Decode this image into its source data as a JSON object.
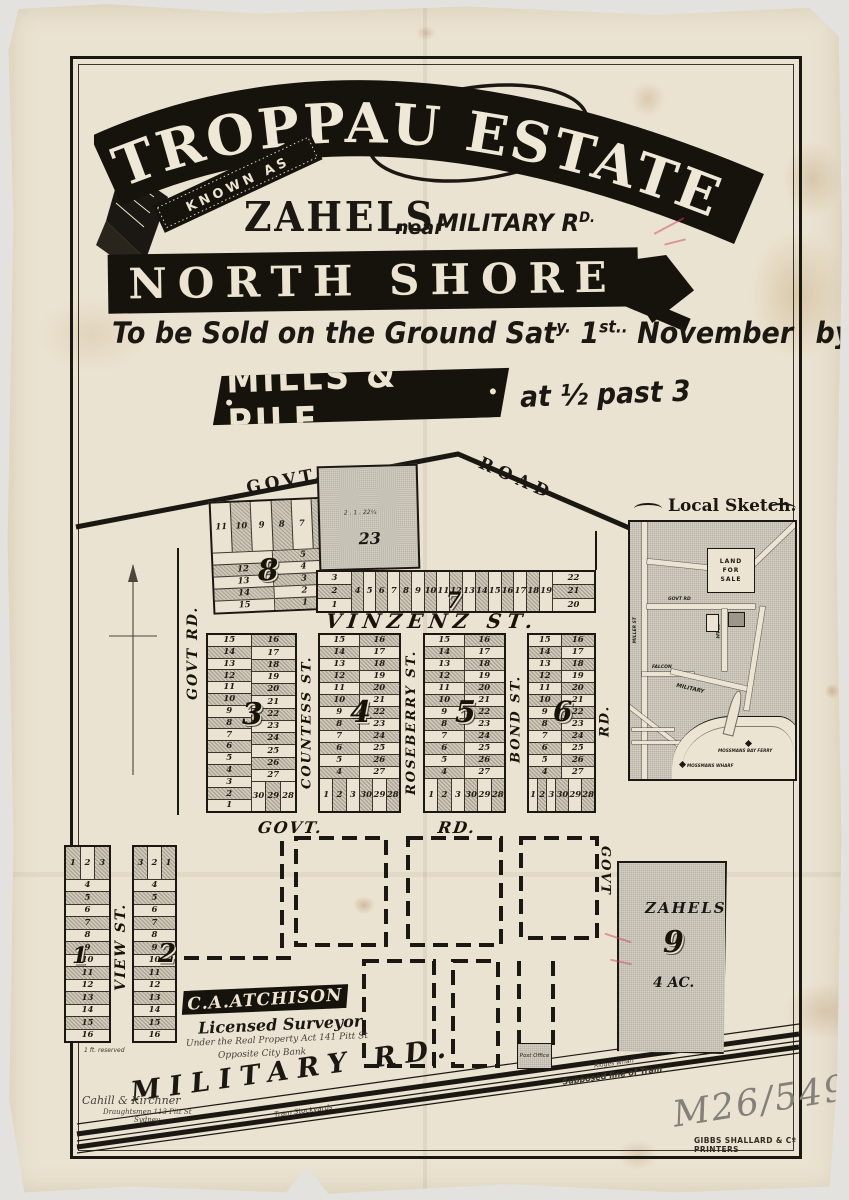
{
  "colors": {
    "paper": "#ebe3d1",
    "ink": "#1b1712",
    "shade": "#cfc9b9",
    "pencil": "#84817a"
  },
  "header": {
    "title": "TROPPAU ESTATE",
    "known_as": "KNOWN AS",
    "estate_name": "ZAHELS",
    "near": "near",
    "road_name": "MILITARY R",
    "road_sup": "D.",
    "region": "NORTH SHORE",
    "sale_pre": "To be Sold on the Ground Sat",
    "sale_sup1": "y.",
    "sale_mid": "1",
    "sale_sup2": "st..",
    "sale_post": "November",
    "sale_by": "by",
    "auctioneer": "MILLS & PILE",
    "sale_time": "at ½ past 3"
  },
  "map": {
    "roads": {
      "top_govt": "GOVT.",
      "top_road": "ROAD",
      "left_govt_rd": "GOVT  RD.",
      "vinzenz": "VINZENZ ST.",
      "countess": "COUNTESS ST.",
      "roseberry": "ROSEBERRY ST.",
      "bond": "BOND ST.",
      "mid_govt": "GOVT.",
      "mid_rd": "RD.",
      "right_rd": "RD.",
      "right_govt": "GOVT",
      "view": "VIEW ST.",
      "military": "MILITARY RD.",
      "tram_note": "Supposed line of Tram",
      "stockyards_note": "Tram Stockyards",
      "wharf_note": "Ridges Wharf",
      "reserved_note": "1 ft. reserved"
    },
    "sections": {
      "s8": {
        "num": "8",
        "top": [
          "11",
          "10",
          "9",
          "8",
          "7",
          "6"
        ],
        "left": [
          "",
          "12",
          "13",
          "14",
          "15"
        ],
        "right": [
          "5",
          "4",
          "3",
          "2",
          "1"
        ]
      },
      "s23": {
        "num": "23",
        "dims": "2 . 1 . 22¼"
      },
      "s7": {
        "num": "7",
        "left": [
          "3",
          "2",
          "1"
        ],
        "mid": [
          "4",
          "5",
          "6",
          "7",
          "8",
          "9",
          "10",
          "11",
          "12",
          "13",
          "14",
          "15",
          "16",
          "17",
          "18",
          "19"
        ],
        "right": [
          "22",
          "21",
          "20"
        ]
      },
      "s3": {
        "num": "3",
        "left": [
          "15",
          "14",
          "13",
          "12",
          "11",
          "10",
          "9",
          "8",
          "7",
          "6",
          "5",
          "4",
          "3",
          "2",
          "1"
        ],
        "right": [
          "16",
          "17",
          "18",
          "19",
          "20",
          "21",
          "22",
          "23",
          "24",
          "25",
          "26",
          "27"
        ],
        "bottom": [
          "30",
          "29",
          "28"
        ]
      },
      "s4": {
        "num": "4",
        "left": [
          "15",
          "14",
          "13",
          "12",
          "11",
          "10",
          "9",
          "8",
          "7",
          "6",
          "5",
          "4"
        ],
        "right": [
          "16",
          "17",
          "18",
          "19",
          "20",
          "21",
          "22",
          "23",
          "24",
          "25",
          "26",
          "27"
        ],
        "bottom": [
          "1",
          "2",
          "3",
          "30",
          "29",
          "28"
        ]
      },
      "s5": {
        "num": "5",
        "left": [
          "15",
          "14",
          "13",
          "12",
          "11",
          "10",
          "9",
          "8",
          "7",
          "6",
          "5",
          "4"
        ],
        "right": [
          "16",
          "17",
          "18",
          "19",
          "20",
          "21",
          "22",
          "23",
          "24",
          "25",
          "26",
          "27"
        ],
        "bottom": [
          "1",
          "2",
          "3",
          "30",
          "29",
          "28"
        ]
      },
      "s6": {
        "num": "6",
        "left": [
          "15",
          "14",
          "13",
          "12",
          "11",
          "10",
          "9",
          "8",
          "7",
          "6",
          "5",
          "4"
        ],
        "right": [
          "16",
          "17",
          "18",
          "19",
          "20",
          "21",
          "22",
          "23",
          "24",
          "25",
          "26",
          "27"
        ],
        "bottom": [
          "1",
          "2",
          "3",
          "30",
          "29",
          "28"
        ]
      },
      "s1": {
        "num": "1",
        "top": [
          "1",
          "2",
          "3"
        ],
        "rows": [
          "4",
          "5",
          "6",
          "7",
          "8",
          "9",
          "10",
          "11",
          "12",
          "13",
          "14",
          "15",
          "16"
        ]
      },
      "s2": {
        "num": "2",
        "top": [
          "3",
          "2",
          "1"
        ],
        "rows": [
          "4",
          "5",
          "6",
          "7",
          "8",
          "9",
          "10",
          "11",
          "12",
          "13",
          "14",
          "15",
          "16"
        ]
      },
      "s9": {
        "num": "9",
        "owner": "ZAHELS",
        "area": "4 AC."
      }
    },
    "post_office": "Post Office",
    "sketch": {
      "title": "Local Sketch.",
      "land_for_sale": "LAND FOR SALE",
      "miller": "MILLER ST",
      "govt_rd": "GOVT RD",
      "tram": "TRAM",
      "falcon": "FALCON",
      "military": "MILITARY",
      "wharf": "MOSSMANS WHARF",
      "ferry": "MOSSMANS BAY FERRY"
    }
  },
  "surveyor": {
    "name": "C.A.ATCHISON",
    "title": "Licensed Surveyor",
    "line1": "Under the Real Property Act 141 Pitt St",
    "line2": "Opposite City Bank"
  },
  "credits": {
    "draughtsman": "Cahill & Kirchner",
    "draughtsman_addr": "Draughtsmen 113 Pitt St",
    "draughtsman_city": "Sydney",
    "catalog": "M26/549",
    "printer": "GIBBS SHALLARD & Cº PRINTERS"
  }
}
